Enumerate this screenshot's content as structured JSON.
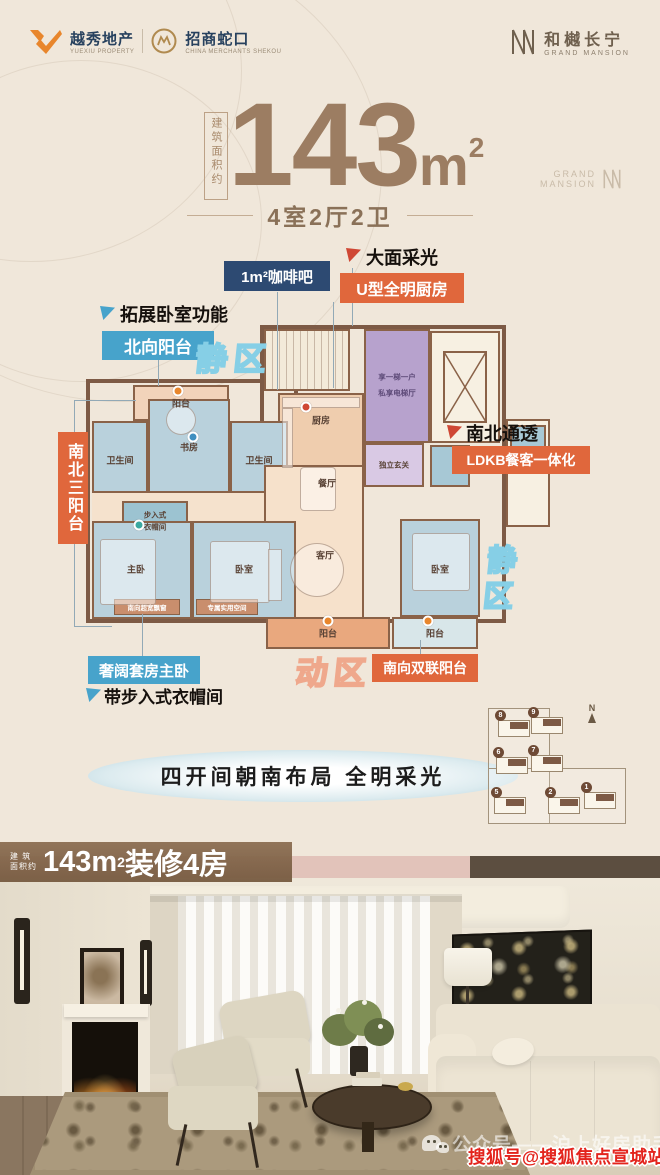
{
  "header": {
    "yuexiu_name": "越秀地产",
    "yuexiu_sub": "YUEXIU PROPERTY",
    "cmsk_name": "招商蛇口",
    "cmsk_sub": "CHINA MERCHANTS SHEKOU",
    "brand_name": "和樾长宁",
    "brand_sub": "GRAND MANSION"
  },
  "hero": {
    "area_label": "建筑面积约",
    "area_number": "143",
    "area_unit": "m",
    "area_power": "2",
    "layout_text": "4室2厅2卫",
    "watermark_line1": "GRAND",
    "watermark_line2": "MANSION"
  },
  "callouts": {
    "coffee_bar": "1m²咖啡吧",
    "big_light": "大面采光",
    "u_kitchen": "U型全明厨房",
    "expand_bedroom": "拓展卧室功能",
    "north_balcony": "北向阳台",
    "quiet_zone_top": "静区",
    "three_balconies": "南北三阳台",
    "north_south": "南北通透",
    "ldkb": "LDKB餐客一体化",
    "quiet_zone_right": "静区",
    "active_zone": "动区",
    "south_balconies": "南向双联阳台",
    "master_suite": "奢阔套房主卧",
    "walk_in_closet": "带步入式衣帽间"
  },
  "plan": {
    "rooms": {
      "balcony_top": "阳台",
      "bath_left": "卫生间",
      "study": "书房",
      "bath_mid": "卫生间",
      "kitchen": "厨房",
      "dining": "餐厅",
      "living": "客厅",
      "closet_line1": "步入式",
      "closet_line2": "衣帽间",
      "master": "主卧",
      "bedroom_left": "卧室",
      "bedroom_right": "卧室",
      "foyer": "独立玄关",
      "elevator_line1": "享一梯一户",
      "elevator_line2": "私享电梯厅",
      "balcony_bottom_center": "阳台",
      "balcony_bottom_right": "阳台",
      "window_note_left": "南向超宽飘窗",
      "window_note_right": "专属实用空间"
    }
  },
  "slogan": "四开间朝南布局 全明采光",
  "siteplan": {
    "north_label": "N",
    "buildings": [
      "8",
      "9",
      "6",
      "7",
      "5",
      "2",
      "1"
    ]
  },
  "banner": {
    "prefix_line1": "建 筑",
    "prefix_line2": "面积约",
    "number": "143m",
    "power": "2",
    "suffix": "装修4房"
  },
  "watermark": {
    "wechat_text": "公众号——沪上好房助手",
    "sohu_text": "搜狐号@搜狐焦点宣城站"
  },
  "colors": {
    "accent_orange": "#e0673c",
    "accent_blue": "#47a3cb",
    "accent_navy": "#2d4a72",
    "title_brown": "#9c7d62",
    "wall_brown": "#7d5a45",
    "room_purple": "#b7a2cd",
    "sohu_red": "#e3241d"
  }
}
